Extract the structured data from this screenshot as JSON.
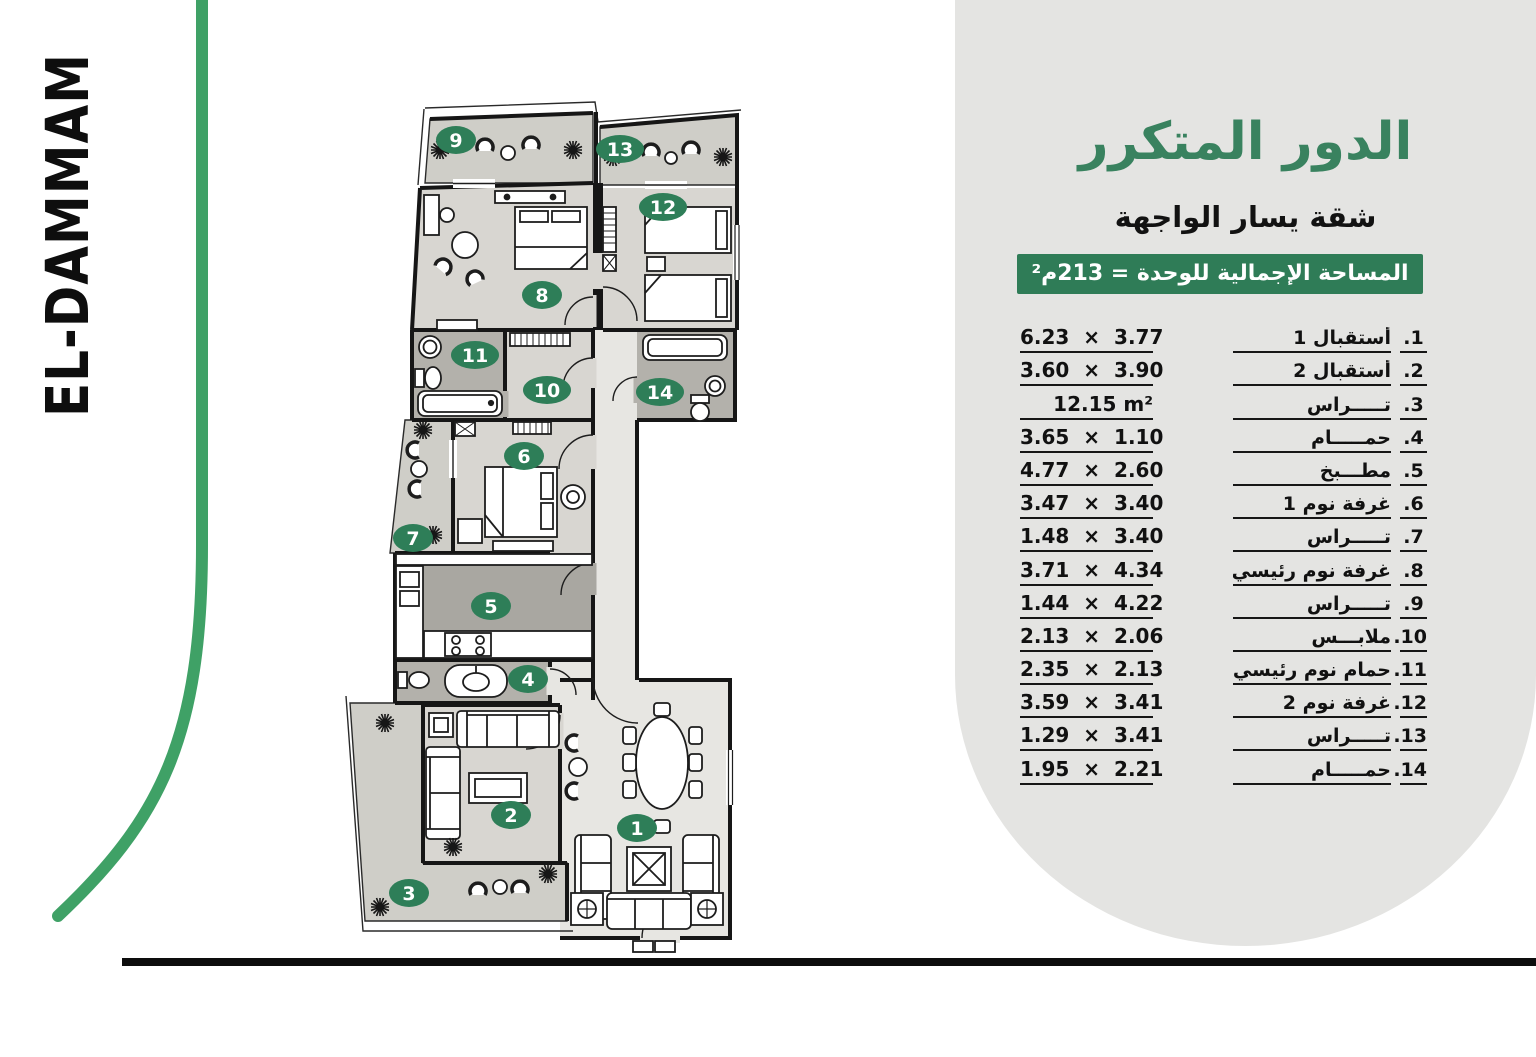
{
  "brand": {
    "name": "EL-DAMMAM"
  },
  "panel": {
    "title": "الدور المتكرر",
    "subtitle": "شقة يسار الواجهة",
    "area_banner": "المساحة الإجمالية للوحدة = 213م²",
    "rooms": [
      {
        "no": "1.",
        "name": "أستقبال 1",
        "dims": "6.23 × 3.77"
      },
      {
        "no": "2.",
        "name": "أستقبال 2",
        "dims": "3.60 × 3.90"
      },
      {
        "no": "3.",
        "name": "تـــــراس",
        "dims": "12.15 m²"
      },
      {
        "no": "4.",
        "name": "حمـــــام",
        "dims": "3.65 × 1.10"
      },
      {
        "no": "5.",
        "name": "مطـــبخ",
        "dims": "4.77 × 2.60"
      },
      {
        "no": "6.",
        "name": "غرفة نوم 1",
        "dims": "3.47 × 3.40"
      },
      {
        "no": "7.",
        "name": "تـــــراس",
        "dims": "1.48 × 3.40"
      },
      {
        "no": "8.",
        "name": "غرفة نوم رئيسي",
        "dims": "3.71 × 4.34"
      },
      {
        "no": "9.",
        "name": "تـــــراس",
        "dims": "1.44 × 4.22"
      },
      {
        "no": "10.",
        "name": "ملابـــس",
        "dims": "2.13 × 2.06"
      },
      {
        "no": "11.",
        "name": "حمام نوم رئيسي",
        "dims": "2.35 × 2.13"
      },
      {
        "no": "12.",
        "name": "غرفة نوم 2",
        "dims": "3.59 × 3.41"
      },
      {
        "no": "13.",
        "name": "تـــــراس",
        "dims": "1.29 × 3.41"
      },
      {
        "no": "14.",
        "name": "حمـــــام",
        "dims": "1.95 × 2.21"
      }
    ]
  },
  "plan": {
    "badges": [
      "1",
      "2",
      "3",
      "4",
      "5",
      "6",
      "7",
      "8",
      "9",
      "10",
      "11",
      "12",
      "13",
      "14"
    ]
  },
  "colors": {
    "accent_green": "#2f7c57",
    "badge_green": "#2e7e58",
    "title_green": "#39825f",
    "curve_green": "#3fa166",
    "panel_gray": "#e4e4e2",
    "ink": "#111111"
  }
}
